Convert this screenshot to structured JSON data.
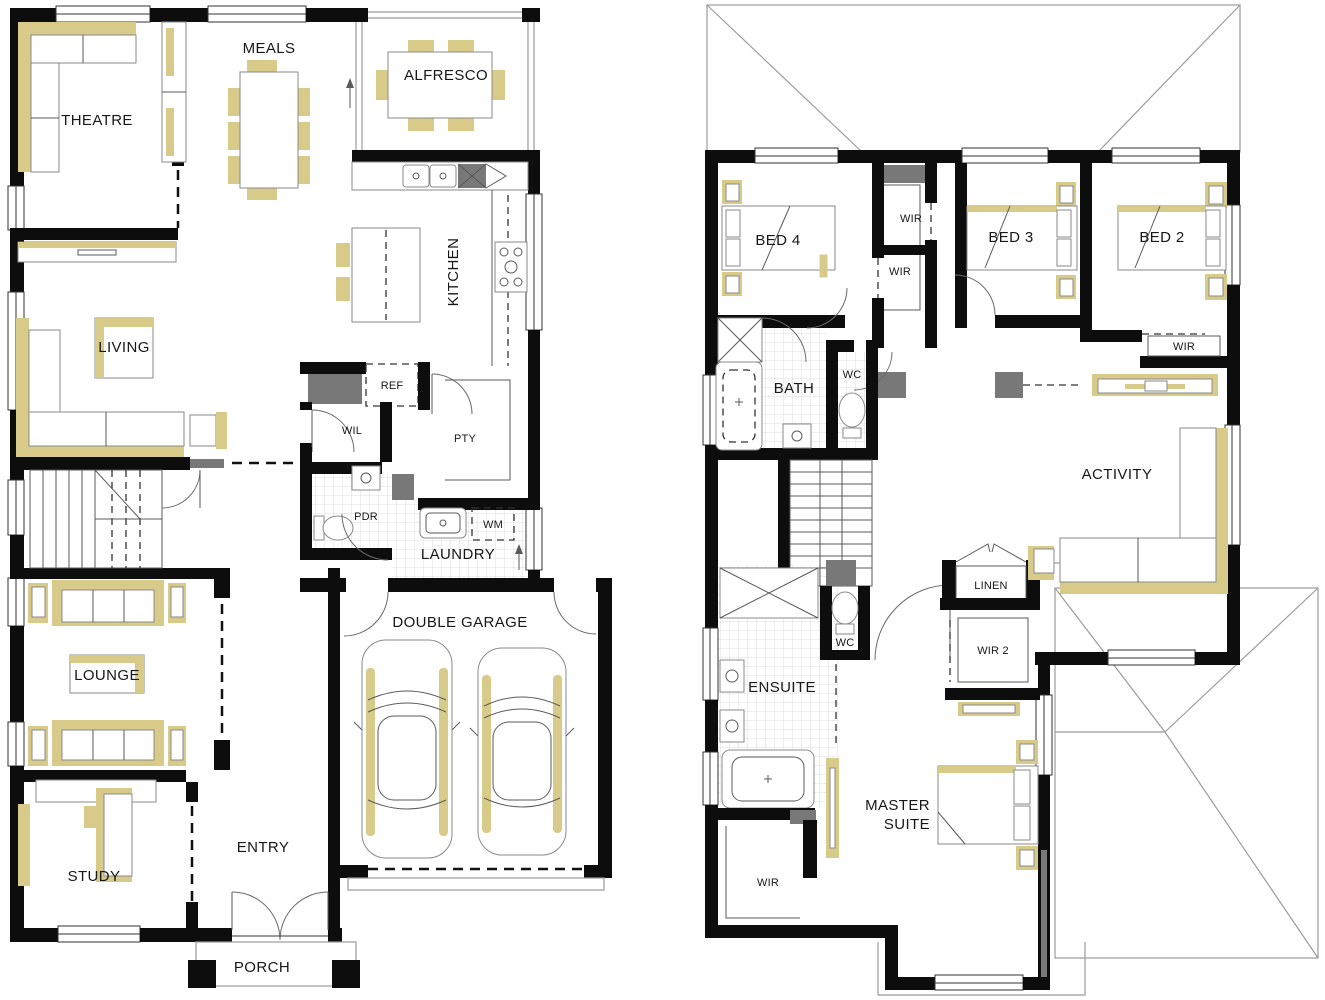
{
  "title": "Double storey home floor plan",
  "colors": {
    "wall": "#0d0d0d",
    "furniture_accent": "#d8cb8a",
    "fixture_gray": "#787878",
    "roof_line": "#9b9b9b",
    "tile_line": "#dcdcdc",
    "label_text": "#171717"
  },
  "ground": {
    "theatre": "THEATRE",
    "meals": "MEALS",
    "alfresco": "ALFRESCO",
    "kitchen": "KITCHEN",
    "living": "LIVING",
    "ref": "REF",
    "wil": "WIL",
    "pty": "PTY",
    "pdr": "PDR",
    "laundry": "LAUNDRY",
    "wm": "WM",
    "lounge": "LOUNGE",
    "study": "STUDY",
    "entry": "ENTRY",
    "garage": "DOUBLE GARAGE",
    "porch": "PORCH"
  },
  "first": {
    "bed4": "BED 4",
    "wir_top": "WIR",
    "wir_mid": "WIR",
    "bed3": "BED 3",
    "bed2": "BED 2",
    "wir_bed2": "WIR",
    "bath": "BATH",
    "wc_bath": "WC",
    "activity": "ACTIVITY",
    "linen": "LINEN",
    "wc_ens": "WC",
    "wir2": "WIR 2",
    "ensuite": "ENSUITE",
    "master1": "MASTER",
    "master2": "SUITE",
    "wir_master": "WIR"
  }
}
